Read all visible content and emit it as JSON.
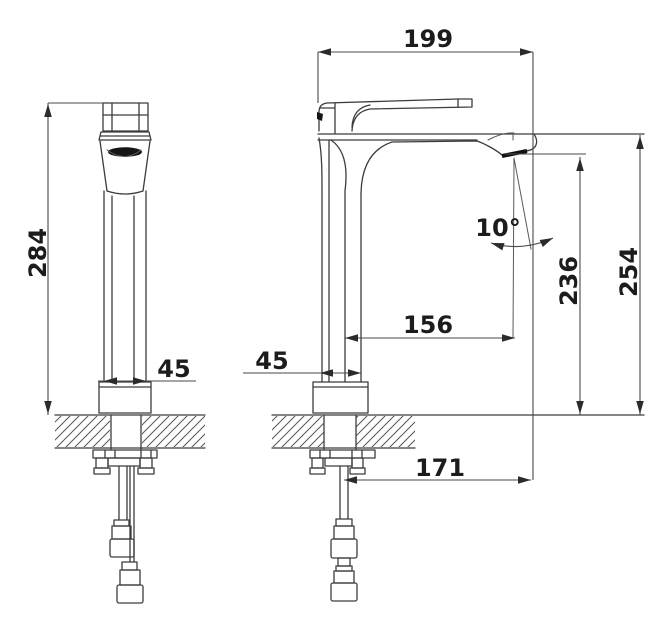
{
  "drawing": {
    "type": "technical-dimension-drawing",
    "subject": "single-lever tall basin faucet, front and side views with mounting hoses",
    "colors": {
      "background": "#ffffff",
      "line": "#3c3c3c",
      "text": "#1c1c1c"
    },
    "dims": {
      "front_total_height": "284",
      "front_base_width": "45",
      "side_base_width": "45",
      "spout_length": "199",
      "stream_angle": "10°",
      "spout_reach": "156",
      "outlet_height": "236",
      "overall_height": "254",
      "hose_offset": "171"
    }
  }
}
